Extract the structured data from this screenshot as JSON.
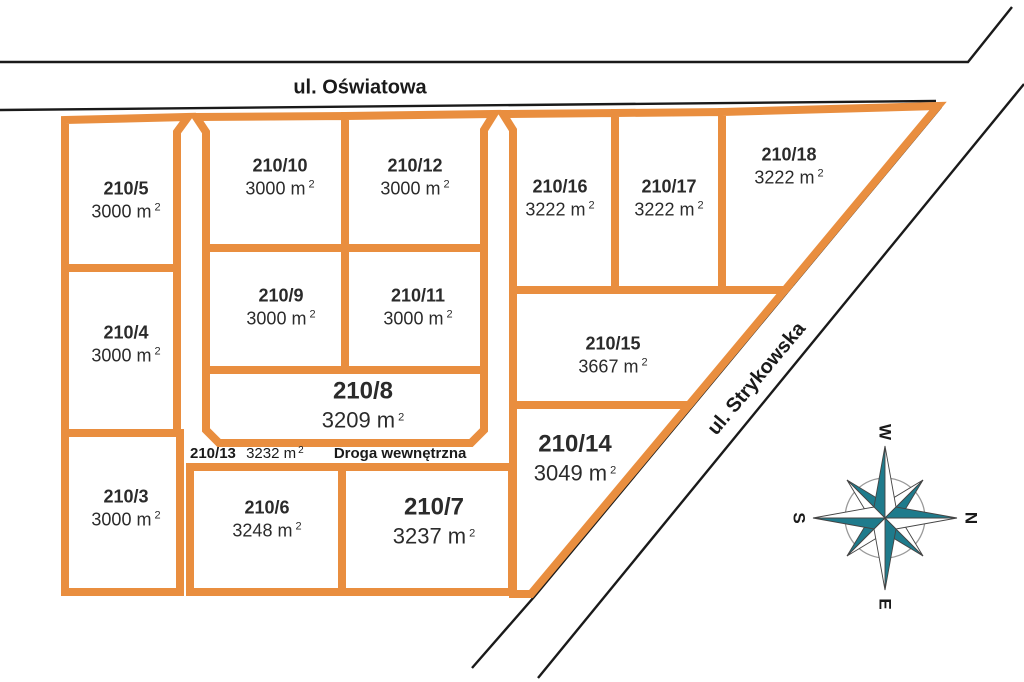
{
  "streets": {
    "oswiatowa": "ul. Oświatowa",
    "strykowska": "ul. Strykowska"
  },
  "internal_road": {
    "id": "210/13",
    "area": "3232 m",
    "name": "Droga wewnętrzna"
  },
  "area_sup": "2",
  "parcels": [
    {
      "id": "210/5",
      "area": "3000 m"
    },
    {
      "id": "210/4",
      "area": "3000 m"
    },
    {
      "id": "210/3",
      "area": "3000 m"
    },
    {
      "id": "210/10",
      "area": "3000 m"
    },
    {
      "id": "210/12",
      "area": "3000 m"
    },
    {
      "id": "210/9",
      "area": "3000 m"
    },
    {
      "id": "210/11",
      "area": "3000 m"
    },
    {
      "id": "210/8",
      "area": "3209 m"
    },
    {
      "id": "210/6",
      "area": "3248 m"
    },
    {
      "id": "210/7",
      "area": "3237 m"
    },
    {
      "id": "210/16",
      "area": "3222 m"
    },
    {
      "id": "210/17",
      "area": "3222 m"
    },
    {
      "id": "210/18",
      "area": "3222 m"
    },
    {
      "id": "210/15",
      "area": "3667 m"
    },
    {
      "id": "210/14",
      "area": "3049 m"
    }
  ],
  "compass": {
    "n": "N",
    "s": "S",
    "e": "E",
    "w": "W"
  },
  "colors": {
    "parcel_boundary_orange": "#E98E3F",
    "road_line_black": "#1a1a1a",
    "compass_teal": "#1F7B8C",
    "compass_ring_gray": "#9a9a9a",
    "text_dark": "#2b2b2b"
  }
}
